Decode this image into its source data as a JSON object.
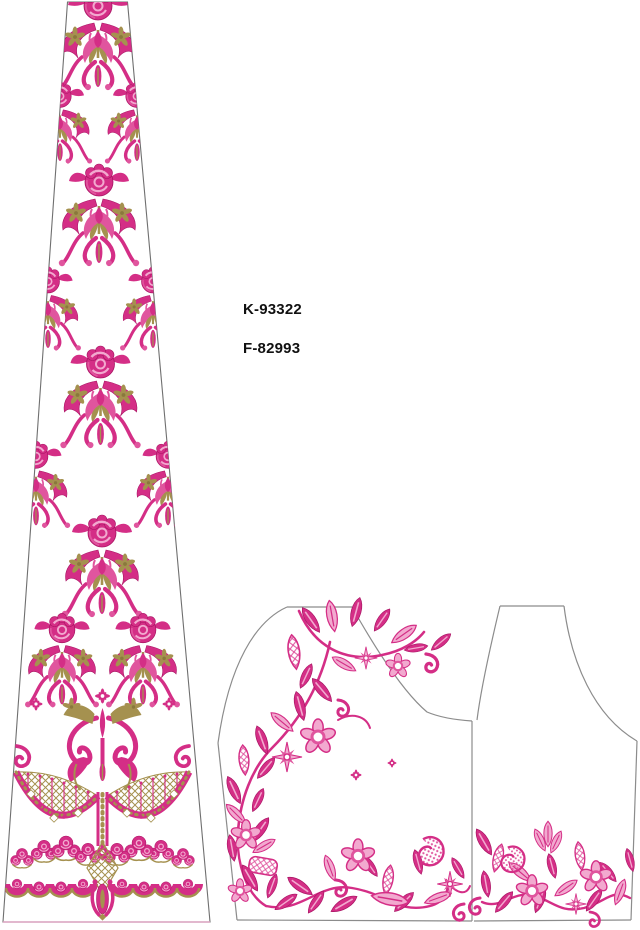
{
  "labels": {
    "code1": "K-93322",
    "code2": "F-82993"
  },
  "colors": {
    "pink": "#D42E86",
    "pink_dark": "#A81463",
    "pink_mid": "#E0559E",
    "pink_light": "#F2A9CF",
    "gold": "#A5914F",
    "gold_dark": "#8A783C",
    "outline": "#8C8C8C",
    "ink": "#111111",
    "paper": "#FFFFFF"
  }
}
